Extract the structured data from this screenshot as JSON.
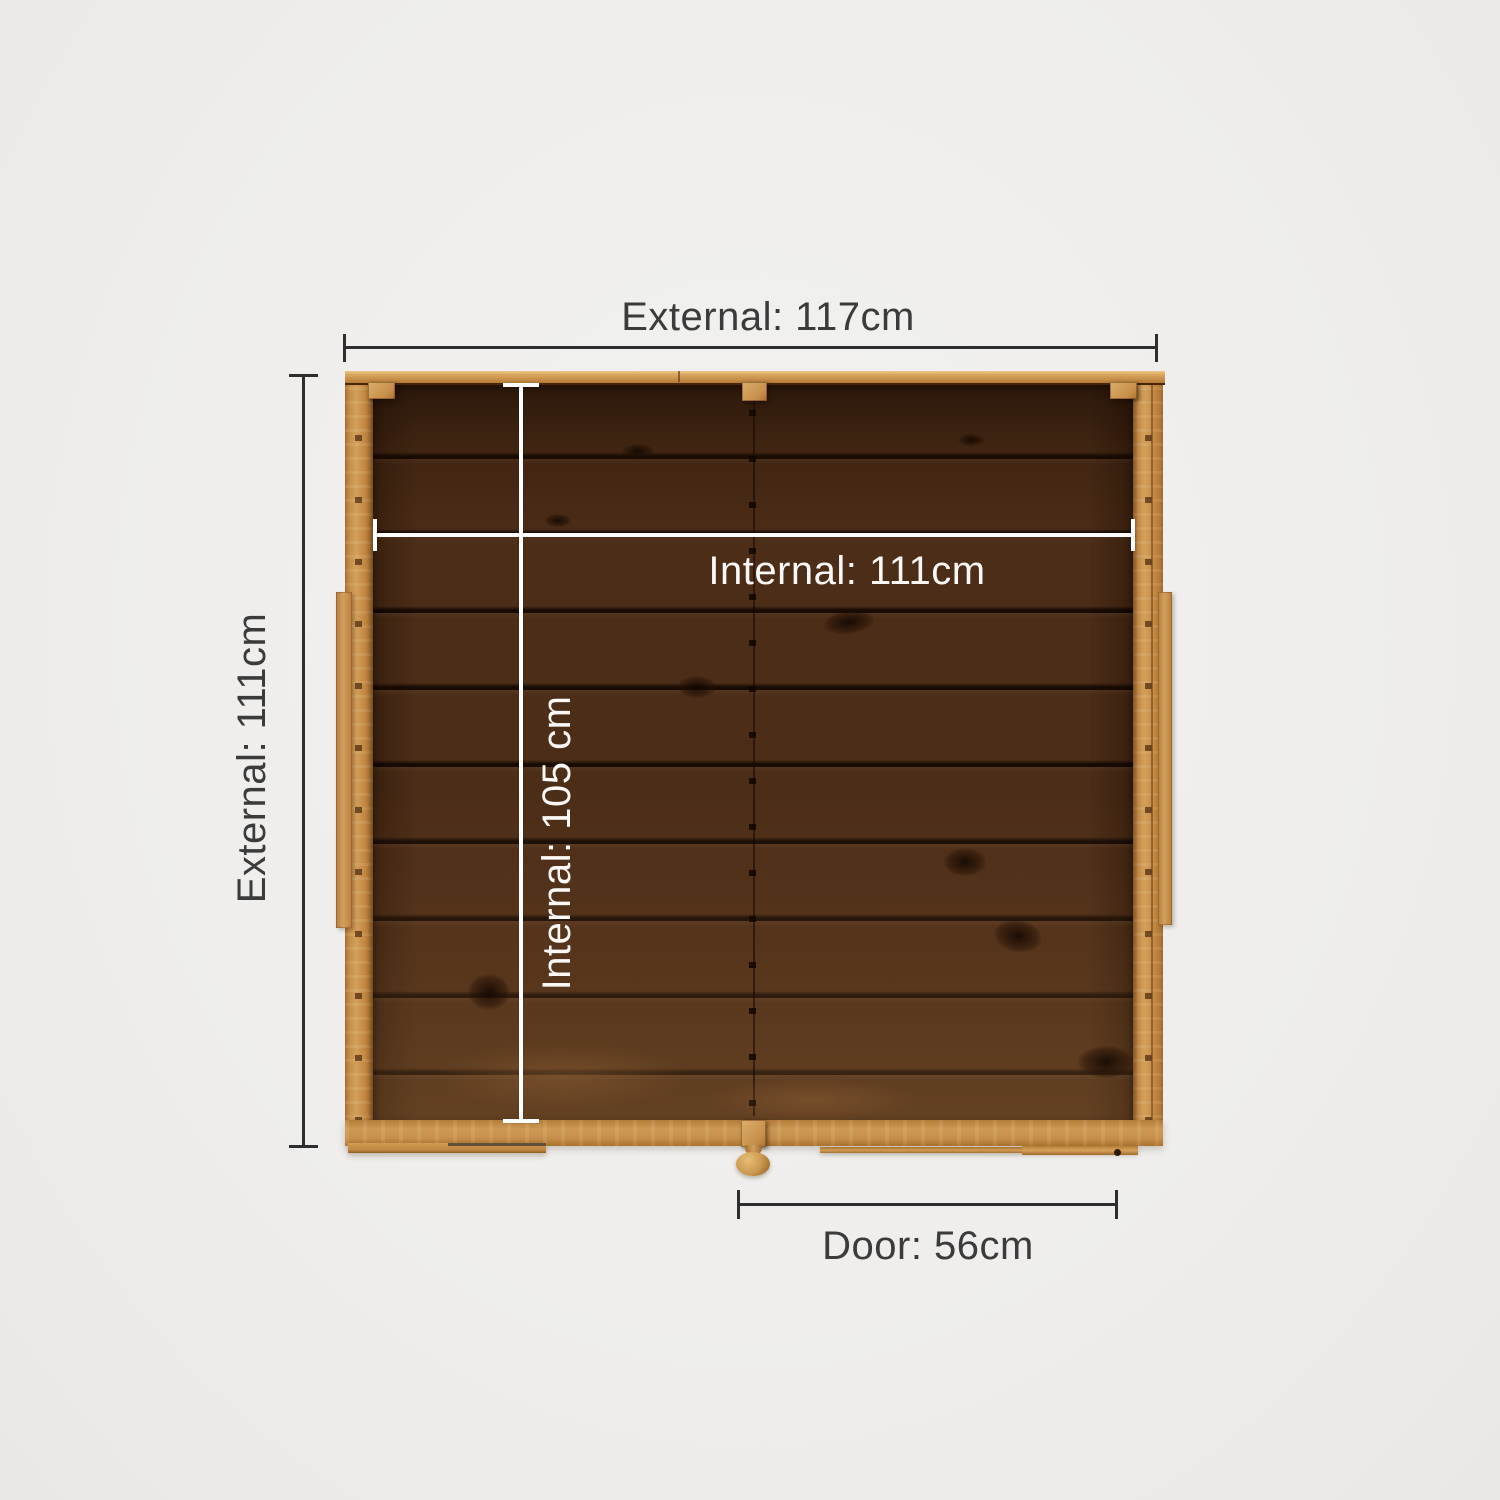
{
  "dimensions": {
    "external_width": {
      "label": "External: 117cm",
      "value_cm": 117
    },
    "external_depth": {
      "label": "External: 111cm",
      "value_cm": 111
    },
    "internal_width": {
      "label": "Internal: 111cm",
      "value_cm": 111
    },
    "internal_depth": {
      "label": "Internal: 105 cm",
      "value_cm": 105
    },
    "door_width": {
      "label": "Door: 56cm",
      "value_cm": 56
    }
  },
  "colors": {
    "background": "#f0efee",
    "dimension_line": "#2e2e2e",
    "dimension_text": "#3b3b3b",
    "internal_dimension_line": "#ffffff",
    "wood_frame": "#c78f4b",
    "wood_floor": "#4c2d17"
  }
}
